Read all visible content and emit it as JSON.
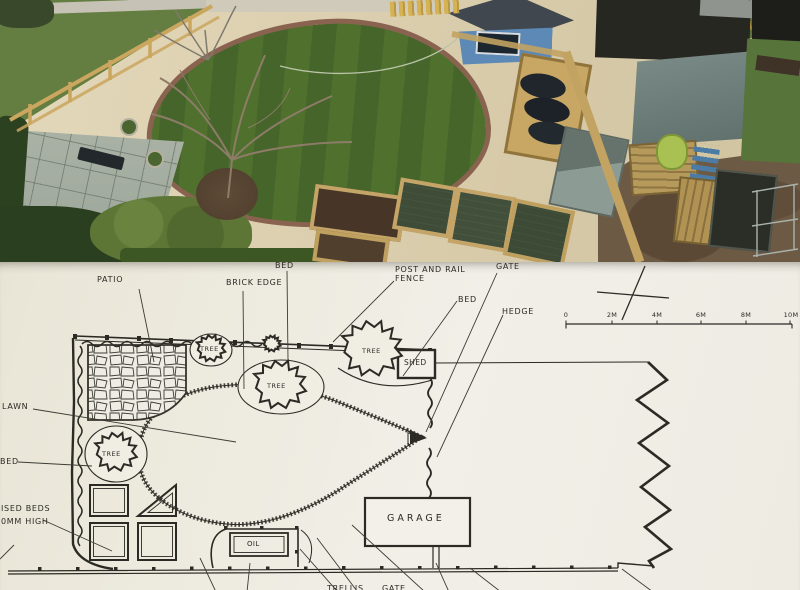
{
  "colors": {
    "ink": "#2b2a24",
    "paper": "#efece1",
    "gravel": "#dccfae",
    "lawn_green": "#4e6e2c",
    "field_green": "#647d40",
    "hedge_dark": "#2c4120",
    "brick_edge": "#8a6350",
    "patio_grey": "#a9b2a5",
    "fence_wood": "#c4a562",
    "shed_blue": "#5d89b6",
    "shed_roof": "#40474e",
    "dark_shed": "#272721",
    "leanto_roof": "#70827e",
    "dirt": "#6d5a45",
    "soil": "#4c3b2c",
    "mesh_green": "#42503a",
    "barrel_green": "#a9c153"
  },
  "photo": {
    "name": "aerial photo of garden"
  },
  "plan": {
    "labels": {
      "patio": "PATIO",
      "brick_edge": "BRICK EDGE",
      "bed_top": "BED",
      "post_and_rail_1": "POST AND RAIL",
      "post_and_rail_2": "FENCE",
      "gate": "GATE",
      "bed_right": "BED",
      "hedge": "HEDGE",
      "shed": "SHED",
      "lawn": "LAWN",
      "bed_left": "BED",
      "raised_beds_1": "ISED BEDS",
      "raised_beds_2": "0MM HIGH",
      "garage": "GARAGE",
      "oil": "OIL",
      "trellis_partial": "TRELLIS",
      "gate_partial": "GATE"
    },
    "tree_labels": [
      "TREE",
      "TREE",
      "TREE",
      "TREE"
    ],
    "scale_bar": {
      "ticks": [
        "0",
        "2M",
        "4M",
        "6M",
        "8M",
        "10M"
      ]
    }
  }
}
